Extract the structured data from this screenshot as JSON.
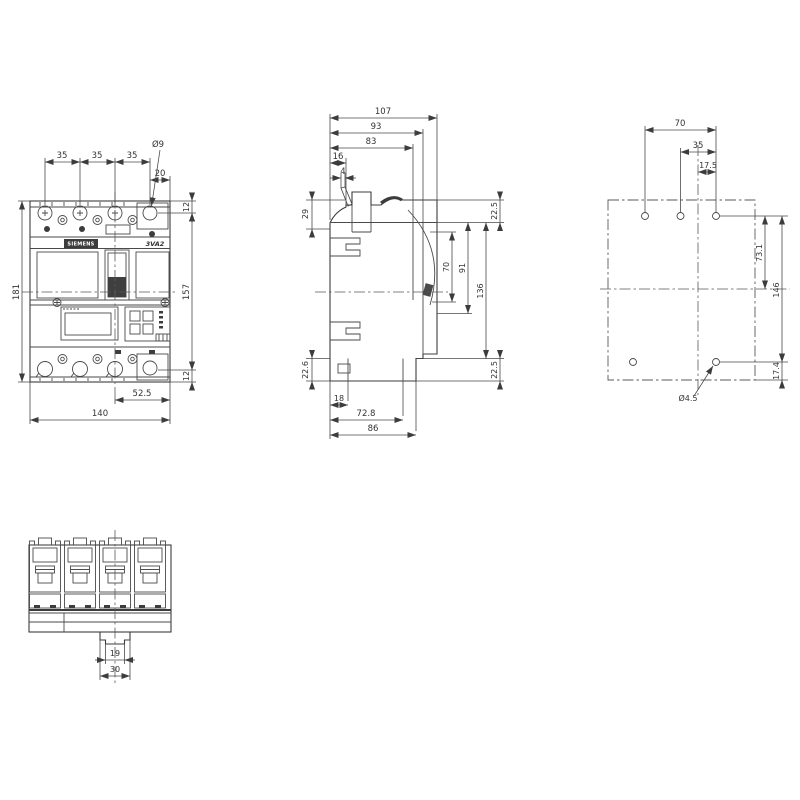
{
  "drawing": {
    "brand": "SIEMENS",
    "model": "3VA2",
    "front": {
      "pitch1": "35",
      "pitch2": "35",
      "pitch3": "35",
      "edge_offset": "20",
      "hole_dia": "Ø9",
      "hole_top": "12",
      "hole_span": "157",
      "hole_bottom": "12",
      "height": "181",
      "handle_to_edge": "52.5",
      "width": "140"
    },
    "side": {
      "depth_total": "107",
      "depth_93": "93",
      "depth_83": "83",
      "front_16": "16",
      "toggle_4": "4",
      "top_29": "29",
      "top_right_225": "22.5",
      "window_70": "70",
      "trip_91": "91",
      "mid_136": "136",
      "bottom_left_226": "22.6",
      "bottom_right_225": "22.5",
      "foot_18": "18",
      "foot_728": "72.8",
      "foot_86": "86"
    },
    "drill": {
      "span_70": "70",
      "pitch_35": "35",
      "half_175": "17.5",
      "row_731": "73.1",
      "rows_146": "146",
      "bottom_174": "17.4",
      "hole_dia": "Ø4.5"
    },
    "bottom": {
      "slot_19": "19",
      "tab_30": "30"
    }
  }
}
